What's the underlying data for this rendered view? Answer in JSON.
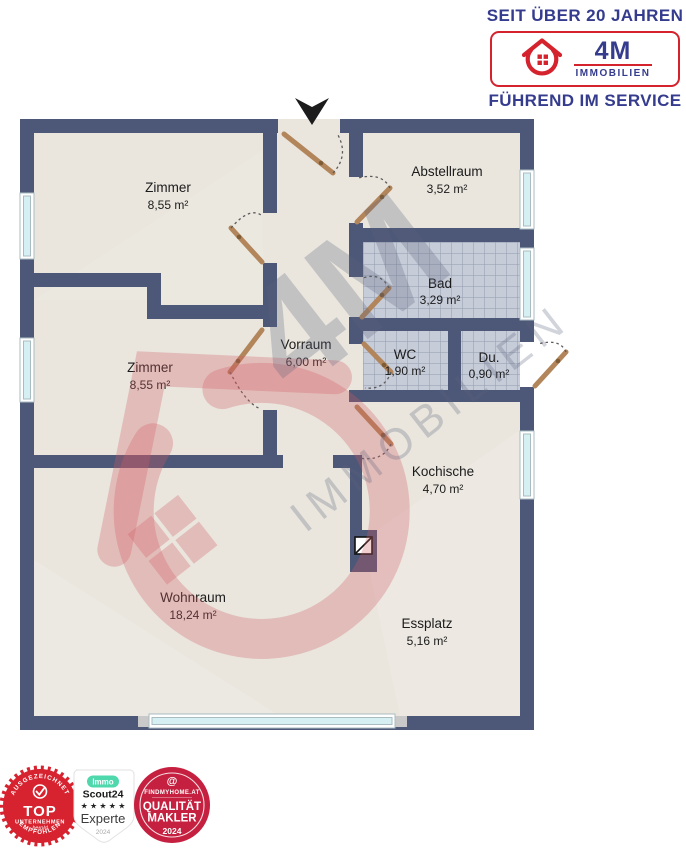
{
  "header": {
    "tagline_top": "SEIT ÜBER 20 JAHREN",
    "logo_brand": "4M",
    "logo_sub": "IMMOBILIEN",
    "tagline_bottom": "FÜHREND IM SERVICE"
  },
  "floorplan": {
    "rooms": [
      {
        "name": "Zimmer",
        "area": "8,55 m²"
      },
      {
        "name": "Abstellraum",
        "area": "3,52 m²"
      },
      {
        "name": "Bad",
        "area": "3,29 m²"
      },
      {
        "name": "Zimmer",
        "area": "8,55 m²"
      },
      {
        "name": "Vorraum",
        "area": "6,00 m²"
      },
      {
        "name": "WC",
        "area": "1,90 m²"
      },
      {
        "name": "Du.",
        "area": "0,90 m²"
      },
      {
        "name": "Kochische",
        "area": "4,70 m²"
      },
      {
        "name": "Wohnraum",
        "area": "18,24 m²"
      },
      {
        "name": "Essplatz",
        "area": "5,16 m²"
      }
    ],
    "watermark_brand": "4M",
    "watermark_text": "IMMOBILIEN"
  },
  "badges": {
    "award": {
      "arc_top": "AUSGEZEICHNET",
      "title": "TOP",
      "subtitle": "UNTERNEHMEN",
      "signature": "herold",
      "arc_bottom": "EMPFOHLEN"
    },
    "immoscout": {
      "pill": "Immo",
      "brand": "Scout24",
      "stars": "★ ★ ★ ★ ★",
      "label": "Experte",
      "year": "2024"
    },
    "findmyhome": {
      "at_symbol": "@",
      "brand": "FINDMYHOME.AT",
      "title1": "QUALITÄT",
      "title2": "MAKLER",
      "year": "2024"
    }
  },
  "colors": {
    "brand_navy": "#353c8e",
    "brand_red": "#d5232e",
    "wall": "#4d5777",
    "floor": "#eae6de",
    "window_glass": "#d5eff3",
    "door": "#b2855a",
    "badge_red": "#d6232f",
    "badge_crimson": "#c5203f",
    "badge_mint": "#4fd8ac"
  }
}
